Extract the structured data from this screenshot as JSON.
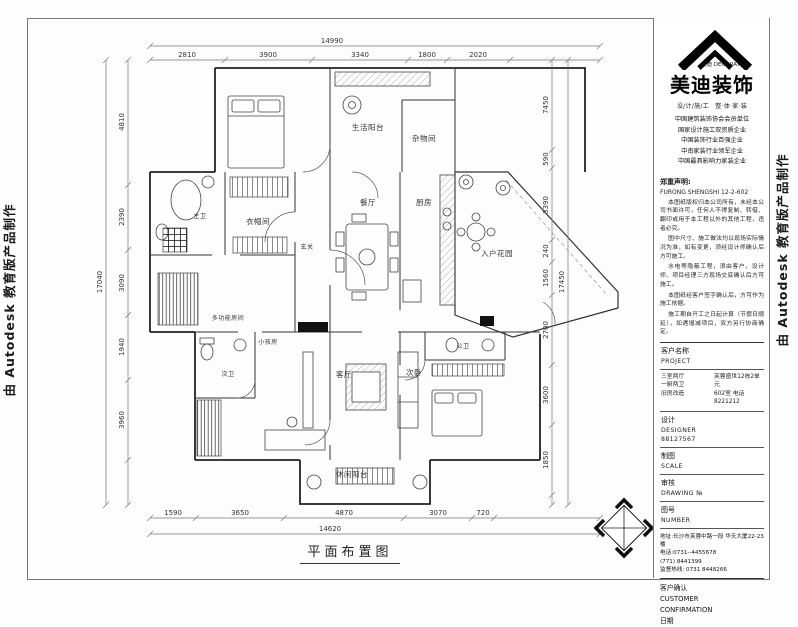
{
  "caption": "平面布置图",
  "watermarks": {
    "left": "由 Autodesk 教育版产品制作",
    "right": "由 Autodesk 教育版产品制作"
  },
  "rooms": [
    {
      "name": "生活阳台"
    },
    {
      "name": "杂物间"
    },
    {
      "name": "餐厅"
    },
    {
      "name": "厨房"
    },
    {
      "name": "入户花园"
    },
    {
      "name": "主卫"
    },
    {
      "name": "衣帽间"
    },
    {
      "name": "玄关"
    },
    {
      "name": "多功能房间"
    },
    {
      "name": "小孩房"
    },
    {
      "name": "次卫"
    },
    {
      "name": "客厅"
    },
    {
      "name": "公卫"
    },
    {
      "name": "次卧"
    },
    {
      "name": "休闲阳台"
    }
  ],
  "dims": {
    "top": {
      "overall": "14990",
      "segments": [
        "2810",
        "3900",
        "3340",
        "1800",
        "2020"
      ]
    },
    "bottom": {
      "overall": "14620",
      "segments": [
        "1590",
        "3650",
        "4870",
        "3070",
        "720"
      ]
    },
    "left": {
      "overall": "17040",
      "segments": [
        "4810",
        "2390",
        "3090",
        "1940",
        "3960"
      ]
    },
    "right": {
      "overall": "17450",
      "segments": [
        "7450",
        "590",
        "3390",
        "240",
        "1560",
        "2700",
        "3600",
        "1850"
      ]
    }
  },
  "brand": {
    "mark": "美迪 DECORATION",
    "name": "美迪装饰",
    "tagline": "设/计/施/工　整·体·家·装",
    "certs": [
      "中国建筑装饰协会会员单位",
      "国家设计施工双资质企业",
      "中国装饰行业百强企业",
      "中南家装行业领军企业",
      "中国最具影响力家装企业"
    ]
  },
  "notes": {
    "heading": "郑重声明:",
    "code": "FURONG SHENGSHI 12-2-602",
    "paragraphs": [
      "本图纸版权归本公司所有，未经本公司书面许可，任何人不得复制、转借、翻印或用于本工程以外的其他工程，违者必究。",
      "图中尺寸、施工做法均以现场实际情况为准，如有变更，须经设计师确认后方可施工。",
      "水电等隐蔽工程，须由客户、设计师、项目经理三方现场交底确认后方可施工。",
      "本图纸经客户签字确认后，方可作为施工依据。",
      "施工期自开工之日起计算（节假日顺延），如遇增减项目，双方另行协商确定。"
    ]
  },
  "fields": {
    "row1_label": "客户名称",
    "row1_value": "PROJECT",
    "row2_l1": "三室两厅",
    "row2_l2": "一厨两卫",
    "row2_l3": "旧房改造",
    "row2_r1": "芙蓉盛世12栋2单元",
    "row2_r2": "602室 电话8221212",
    "row3_label": "设计",
    "row3_v1": "DESIGNER",
    "row3_v2": "88127567",
    "row4_label": "制图",
    "row4_value": "SCALE",
    "row5_label": "审核",
    "row5_value": "DRAWING №",
    "row6_label": "图号",
    "row6_value": "NUMBER"
  },
  "contact": {
    "line1": "地址:长沙市芙蓉中路一段 华天大厦22-23楼",
    "line2": "电话:0731--4455678",
    "line3": "(771) 8441399",
    "line4": "监督热线: 0731 8448266"
  },
  "confirm": {
    "title": "客户确认",
    "en1": "CUSTOMER",
    "en2": "CONFIRMATION",
    "date_label": "日期"
  }
}
